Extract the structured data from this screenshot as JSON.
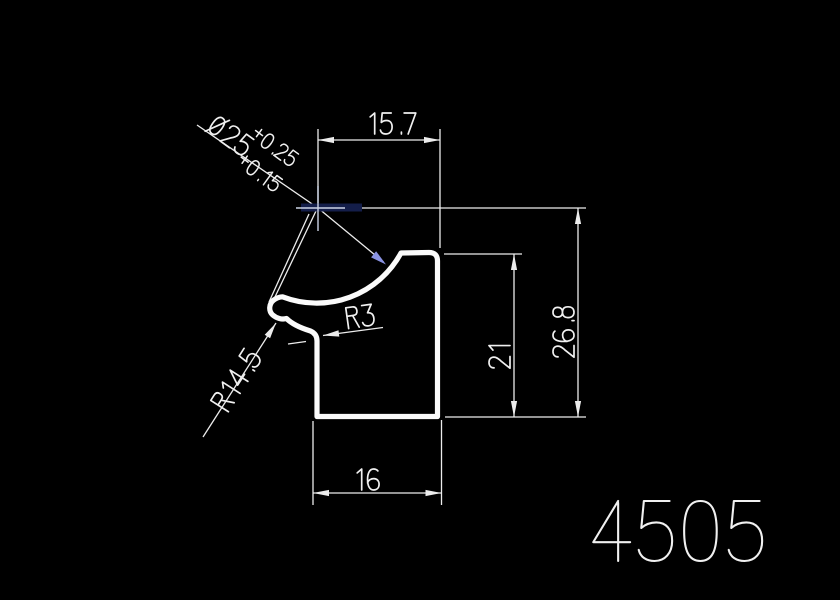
{
  "window": {
    "background": "#000000"
  },
  "drawing": {
    "number": "4505",
    "line_color": "#f0f0f0",
    "accent_color": "#8a93e3",
    "labels": {
      "top_width": "15.7",
      "bottom_width": "16",
      "overall_height": "26.8",
      "body_height": "21",
      "diameter": "Ø25",
      "tol_upper": "+0.25",
      "tol_lower": "+0.15",
      "fillet_radius": "R3",
      "flange_radius": "R14.5"
    }
  }
}
